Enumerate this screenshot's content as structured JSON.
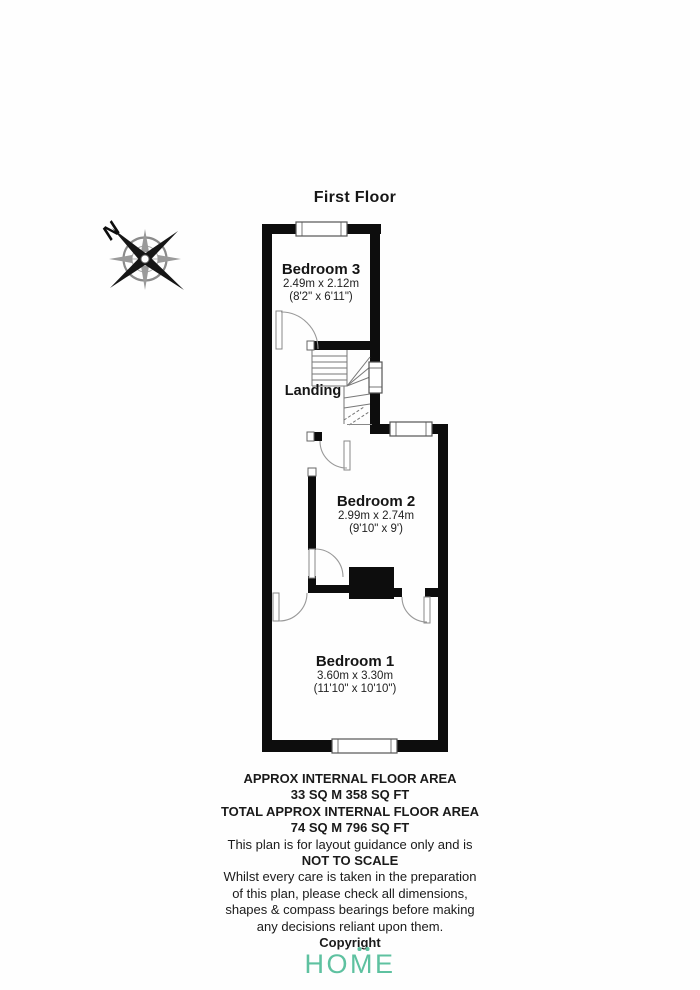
{
  "title": "First Floor",
  "compass": {
    "label": "N"
  },
  "rooms": [
    {
      "id": "bedroom3",
      "name": "Bedroom 3",
      "dim_metric": "2.49m x 2.12m",
      "dim_imperial": "(8'2\" x 6'11\")"
    },
    {
      "id": "landing",
      "name": "Landing"
    },
    {
      "id": "bedroom2",
      "name": "Bedroom 2",
      "dim_metric": "2.99m x 2.74m",
      "dim_imperial": "(9'10\" x 9')"
    },
    {
      "id": "bedroom1",
      "name": "Bedroom 1",
      "dim_metric": "3.60m x 3.30m",
      "dim_imperial": "(11'10\" x 10'10\")"
    }
  ],
  "footer": {
    "lines": [
      "APPROX INTERNAL FLOOR AREA",
      "33 SQ M 358 SQ FT",
      "TOTAL APPROX INTERNAL FLOOR AREA",
      "74 SQ M 796 SQ FT",
      "This plan is for layout guidance only and is",
      "NOT TO SCALE",
      "Whilst every care is taken in the preparation",
      "of this plan, please check all dimensions,",
      "shapes & compass bearings before making",
      "any decisions reliant upon them.",
      "Copyright"
    ]
  },
  "logo": {
    "part1": "HO",
    "m": "M",
    "part2": "E",
    "color": "#5ec1a0"
  }
}
